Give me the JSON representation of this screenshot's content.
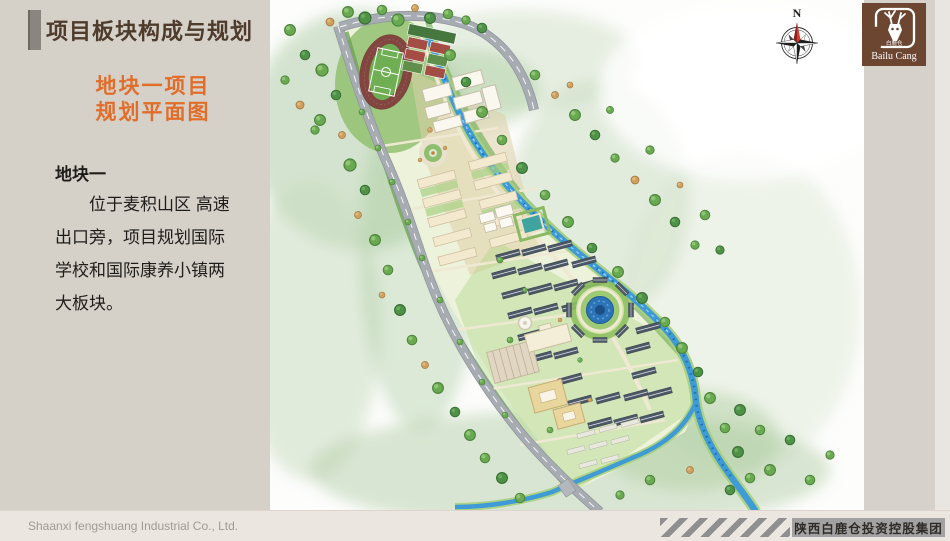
{
  "panel": {
    "title": "项目板块构成与规划",
    "subtitle": "地块一项目\n规划平面图",
    "body_heading": "地块一",
    "body_text": "　　位于麦积山区 高速\n出口旁，项目规划国际\n学校和国际康养小镇两\n大板块。"
  },
  "map": {
    "compass_label": "N"
  },
  "logo": {
    "name": "Bailu Cang",
    "name_cn": "白鹿仓"
  },
  "footer": {
    "company_en": "Shaanxi fengshuang Industrial Co., Ltd.",
    "company_cn": "陕西白鹿仓投资控股集团"
  },
  "colors": {
    "accent_orange": "#e06e2a",
    "title_brown": "#4e3b2c",
    "logo_brown": "#6d4631",
    "panel_gray": "#d5d1c9",
    "footer_beige": "#ece6e0",
    "river_blue": "#3e9bd6",
    "road_gray": "#a7acb2",
    "track_maroon": "#82453f"
  }
}
